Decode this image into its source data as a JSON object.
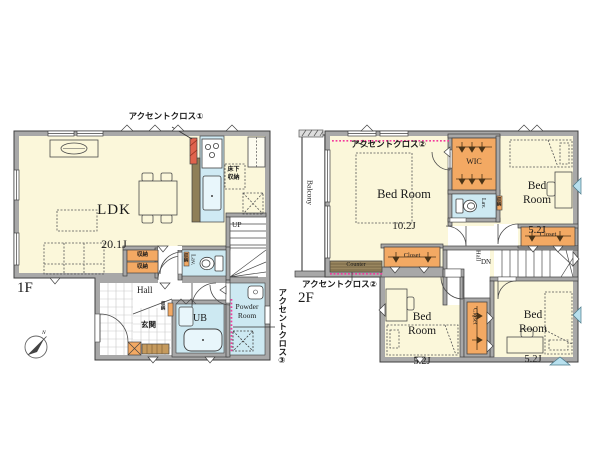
{
  "plan": {
    "floor1": {
      "label": "1F",
      "accent_label_1": "アクセントクロス①",
      "accent_label_3": "アクセントクロス③",
      "ldk_name": "LDK",
      "ldk_size": "20.1J",
      "floor_storage": "床下収納",
      "storage_a": "収納",
      "storage_b": "収納",
      "storage_hall": "収納",
      "storage_lav": "収納",
      "stairs_up": "UP",
      "toilet": "Lav.",
      "hall": "Hall",
      "entrance": "玄関",
      "bath": "UB",
      "powder_room": "Powder Room",
      "compass_north": "N"
    },
    "floor2": {
      "label": "2F",
      "accent_label_2_top": "アクセントクロス②",
      "accent_label_2_bottom": "アクセントクロス②",
      "balcony": "Balcony",
      "bedroom_main_name": "Bed Room",
      "bedroom_main_size": "10.2J",
      "bedroom_ne_name": "Bed Room",
      "bedroom_ne_size": "5.2J",
      "bedroom_sw_name": "Bed Room",
      "bedroom_sw_size": "5.2J",
      "bedroom_se_name": "Bed Room",
      "bedroom_se_size": "5.2J",
      "wic": "WIC",
      "toilet": "Lav.",
      "storage": "収納",
      "hall": "Hall",
      "stairs_down": "DN",
      "counter": "Counter",
      "closet_ne": "Closet",
      "closet_mid": "Closet",
      "closet_sw": "Closet"
    },
    "colors": {
      "floor": "#fbf7da",
      "wall": "#a8a8a8",
      "water": "#cde9f2",
      "storage": "#f3a963",
      "accent_pink": "#f43a9c",
      "accent_wall": "#e0634d",
      "counter_brown": "#9a8760"
    }
  }
}
